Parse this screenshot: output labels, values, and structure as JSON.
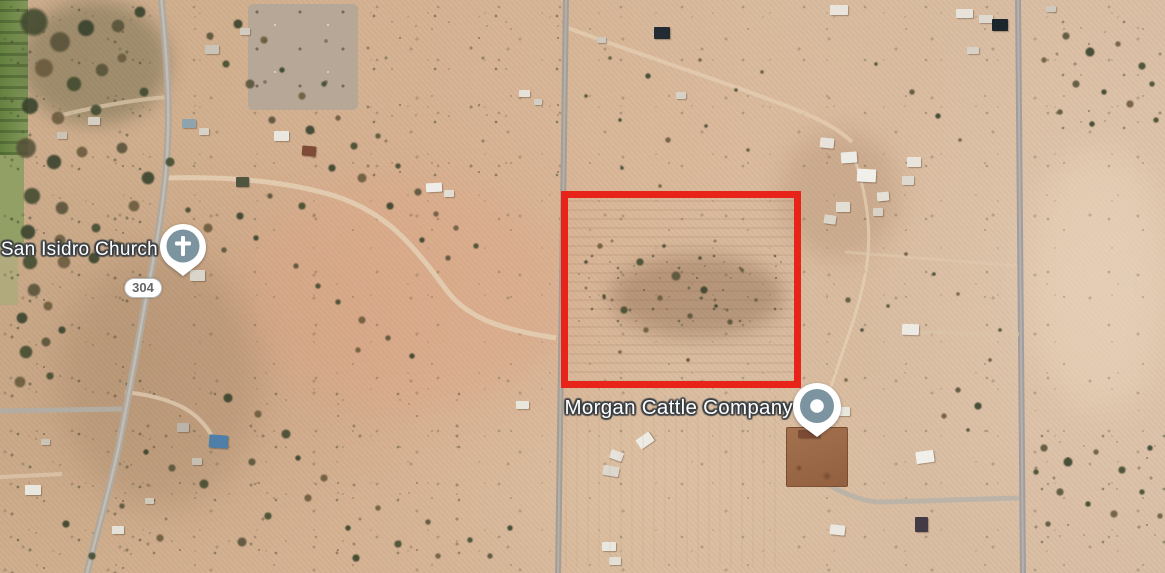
{
  "map": {
    "labels": [
      {
        "id": "church",
        "text": "San Isidro Church",
        "x": 158,
        "y": 250,
        "font_size": 19
      },
      {
        "id": "morgan",
        "text": "Morgan Cattle Company",
        "x": 793,
        "y": 408,
        "font_size": 20.5
      }
    ],
    "route_shield": {
      "text": "304",
      "x": 143,
      "y": 288
    },
    "parcel_outline": {
      "x": 561,
      "y": 191,
      "width": 240,
      "height": 197,
      "thickness": 7,
      "color": "#e8231a"
    },
    "pins": [
      {
        "id": "church",
        "type": "cross-pin",
        "cx": 183,
        "cy": 246
      },
      {
        "id": "morgan",
        "type": "dot-pin",
        "cx": 817,
        "cy": 406
      }
    ],
    "colors": {
      "desert_base": "#d5b292",
      "desert_pink": "#ddb8a0",
      "vegetation": "#40492e",
      "paved_road": "#aba49b",
      "dirt_road": "#e3cdb1",
      "pin_fill": "#7c94a0",
      "parcel_red": "#e8231a",
      "label_text": "#ffffff",
      "label_outline": "#363c40",
      "shield_bg": "#ffffff",
      "shield_text": "#656565",
      "field_green": "#748c4c"
    },
    "tree_colors": [
      "#40492e",
      "#565138",
      "#35402a",
      "#69593c"
    ],
    "buildings": [
      [
        830,
        5,
        18,
        10,
        "#e9e5dd",
        0
      ],
      [
        597,
        37,
        9,
        6,
        "#cfc8bd",
        0
      ],
      [
        654,
        27,
        16,
        12,
        "#232b32",
        0
      ],
      [
        676,
        92,
        10,
        7,
        "#d8d2c6",
        0
      ],
      [
        519,
        90,
        11,
        7,
        "#e6e2da",
        0
      ],
      [
        534,
        99,
        8,
        6,
        "#d5cfc3",
        0
      ],
      [
        956,
        9,
        17,
        9,
        "#e7e3db",
        0
      ],
      [
        979,
        15,
        14,
        8,
        "#dfdad0",
        0
      ],
      [
        992,
        19,
        16,
        12,
        "#1b252c",
        0
      ],
      [
        967,
        47,
        12,
        7,
        "#d8d2c6",
        0
      ],
      [
        1046,
        6,
        10,
        6,
        "#cfc8bd",
        0
      ],
      [
        820,
        138,
        14,
        10,
        "#e7e3db",
        6
      ],
      [
        841,
        152,
        16,
        11,
        "#edebe5",
        -4
      ],
      [
        857,
        169,
        19,
        13,
        "#f1efe9",
        3
      ],
      [
        836,
        202,
        14,
        10,
        "#e3ded4",
        0
      ],
      [
        824,
        215,
        12,
        9,
        "#dad4c9",
        8
      ],
      [
        907,
        157,
        14,
        10,
        "#e9e5dd",
        0
      ],
      [
        902,
        176,
        12,
        9,
        "#ded9cf",
        0
      ],
      [
        877,
        192,
        12,
        9,
        "#e5e1d7",
        -5
      ],
      [
        873,
        208,
        10,
        8,
        "#d7d1c6",
        0
      ],
      [
        182,
        119,
        14,
        9,
        "#8fa3ad",
        0
      ],
      [
        199,
        128,
        10,
        7,
        "#d8d2c6",
        0
      ],
      [
        274,
        131,
        15,
        10,
        "#eae7e0",
        0
      ],
      [
        302,
        146,
        14,
        10,
        "#7e4b38",
        5
      ],
      [
        236,
        177,
        13,
        10,
        "#50553f",
        0
      ],
      [
        88,
        117,
        12,
        8,
        "#d5cfc3",
        0
      ],
      [
        57,
        132,
        10,
        7,
        "#cac3b6",
        0
      ],
      [
        426,
        183,
        16,
        9,
        "#efede7",
        -3
      ],
      [
        444,
        190,
        10,
        7,
        "#e1ddd3",
        0
      ],
      [
        190,
        270,
        15,
        11,
        "#dad5ca",
        0
      ],
      [
        205,
        45,
        14,
        9,
        "#c9c3b8",
        0
      ],
      [
        240,
        28,
        10,
        7,
        "#d2ccc0",
        0
      ],
      [
        209,
        435,
        19,
        13,
        "#4d7fa8",
        4
      ],
      [
        177,
        423,
        12,
        9,
        "#bab3a7",
        0
      ],
      [
        192,
        458,
        10,
        7,
        "#c5beb1",
        0
      ],
      [
        25,
        485,
        16,
        10,
        "#eae7e0",
        0
      ],
      [
        112,
        526,
        12,
        8,
        "#e5e2d9",
        0
      ],
      [
        145,
        498,
        9,
        6,
        "#d0cabd",
        0
      ],
      [
        41,
        439,
        9,
        6,
        "#cac4b7",
        0
      ],
      [
        516,
        401,
        13,
        8,
        "#e9e6de",
        0
      ],
      [
        637,
        435,
        16,
        11,
        "#edebe4",
        -35
      ],
      [
        610,
        451,
        13,
        9,
        "#e7e3db",
        20
      ],
      [
        603,
        466,
        16,
        10,
        "#ddd8cd",
        10
      ],
      [
        602,
        542,
        14,
        9,
        "#eae7e0",
        0
      ],
      [
        609,
        557,
        12,
        8,
        "#e3dfd5",
        0
      ],
      [
        798,
        430,
        22,
        8,
        "#7c4a34",
        0
      ],
      [
        836,
        407,
        14,
        9,
        "#e9e6de",
        0
      ],
      [
        830,
        525,
        15,
        10,
        "#ebe8e1",
        6
      ],
      [
        916,
        451,
        18,
        12,
        "#f1efea",
        -8
      ],
      [
        915,
        517,
        13,
        15,
        "#423b46",
        0
      ],
      [
        902,
        324,
        17,
        11,
        "#edeae3",
        2
      ]
    ],
    "trees": [
      [
        34,
        22,
        15
      ],
      [
        60,
        42,
        11
      ],
      [
        86,
        28,
        9
      ],
      [
        44,
        68,
        10
      ],
      [
        74,
        84,
        8
      ],
      [
        102,
        70,
        7
      ],
      [
        30,
        106,
        9
      ],
      [
        58,
        118,
        7
      ],
      [
        96,
        110,
        6
      ],
      [
        26,
        148,
        11
      ],
      [
        54,
        162,
        8
      ],
      [
        82,
        152,
        6
      ],
      [
        32,
        196,
        9
      ],
      [
        62,
        208,
        7
      ],
      [
        28,
        232,
        8
      ],
      [
        60,
        240,
        6
      ],
      [
        96,
        228,
        5
      ],
      [
        118,
        26,
        7
      ],
      [
        140,
        12,
        6
      ],
      [
        122,
        58,
        5
      ],
      [
        144,
        92,
        5
      ],
      [
        122,
        148,
        6
      ],
      [
        148,
        178,
        7
      ],
      [
        134,
        206,
        6
      ],
      [
        170,
        162,
        5
      ],
      [
        118,
        246,
        5
      ],
      [
        94,
        258,
        6
      ],
      [
        64,
        262,
        7
      ],
      [
        30,
        262,
        8
      ],
      [
        34,
        290,
        7
      ],
      [
        22,
        318,
        6
      ],
      [
        48,
        306,
        5
      ],
      [
        26,
        352,
        7
      ],
      [
        46,
        342,
        5
      ],
      [
        62,
        330,
        4
      ],
      [
        20,
        382,
        6
      ],
      [
        50,
        376,
        4
      ],
      [
        210,
        36,
        4
      ],
      [
        238,
        24,
        5
      ],
      [
        264,
        40,
        4
      ],
      [
        226,
        64,
        4
      ],
      [
        250,
        84,
        5
      ],
      [
        282,
        70,
        3
      ],
      [
        302,
        96,
        4
      ],
      [
        324,
        84,
        3
      ],
      [
        272,
        120,
        4
      ],
      [
        310,
        130,
        5
      ],
      [
        338,
        118,
        3
      ],
      [
        354,
        146,
        4
      ],
      [
        378,
        136,
        3
      ],
      [
        332,
        168,
        4
      ],
      [
        362,
        178,
        5
      ],
      [
        398,
        166,
        3
      ],
      [
        418,
        192,
        4
      ],
      [
        390,
        206,
        4
      ],
      [
        436,
        214,
        3
      ],
      [
        302,
        206,
        4
      ],
      [
        270,
        196,
        3
      ],
      [
        240,
        216,
        4
      ],
      [
        208,
        228,
        5
      ],
      [
        188,
        210,
        3
      ],
      [
        224,
        250,
        3
      ],
      [
        256,
        238,
        3
      ],
      [
        456,
        228,
        3
      ],
      [
        476,
        246,
        3
      ],
      [
        448,
        258,
        3
      ],
      [
        422,
        240,
        3
      ],
      [
        362,
        320,
        4
      ],
      [
        338,
        302,
        3
      ],
      [
        388,
        338,
        3
      ],
      [
        412,
        356,
        3
      ],
      [
        358,
        350,
        3
      ],
      [
        318,
        286,
        3
      ],
      [
        296,
        266,
        3
      ],
      [
        228,
        398,
        5
      ],
      [
        258,
        414,
        4
      ],
      [
        286,
        434,
        5
      ],
      [
        252,
        462,
        4
      ],
      [
        298,
        458,
        3
      ],
      [
        324,
        478,
        4
      ],
      [
        204,
        484,
        5
      ],
      [
        172,
        468,
        4
      ],
      [
        146,
        452,
        3
      ],
      [
        308,
        498,
        4
      ],
      [
        268,
        516,
        4
      ],
      [
        242,
        542,
        5
      ],
      [
        348,
        528,
        3
      ],
      [
        378,
        508,
        3
      ],
      [
        398,
        544,
        4
      ],
      [
        428,
        522,
        3
      ],
      [
        356,
        558,
        4
      ],
      [
        160,
        538,
        4
      ],
      [
        92,
        556,
        4
      ],
      [
        122,
        506,
        3
      ],
      [
        66,
        524,
        4
      ],
      [
        438,
        556,
        3
      ],
      [
        470,
        540,
        3
      ],
      [
        490,
        556,
        3
      ],
      [
        510,
        528,
        3
      ],
      [
        600,
        246,
        3
      ],
      [
        640,
        262,
        4
      ],
      [
        676,
        276,
        5
      ],
      [
        704,
        290,
        4
      ],
      [
        660,
        298,
        3
      ],
      [
        624,
        310,
        4
      ],
      [
        690,
        316,
        3
      ],
      [
        716,
        306,
        2
      ],
      [
        646,
        330,
        3
      ],
      [
        604,
        296,
        2
      ],
      [
        730,
        322,
        3
      ],
      [
        586,
        262,
        2
      ],
      [
        756,
        300,
        2
      ],
      [
        700,
        258,
        2
      ],
      [
        742,
        270,
        2
      ],
      [
        664,
        246,
        2
      ],
      [
        620,
        352,
        2
      ],
      [
        688,
        360,
        2
      ],
      [
        610,
        58,
        2
      ],
      [
        648,
        76,
        3
      ],
      [
        700,
        60,
        2
      ],
      [
        736,
        90,
        2
      ],
      [
        762,
        72,
        2
      ],
      [
        620,
        120,
        2
      ],
      [
        668,
        140,
        3
      ],
      [
        706,
        126,
        2
      ],
      [
        748,
        150,
        2
      ],
      [
        622,
        168,
        2
      ],
      [
        660,
        186,
        2
      ],
      [
        586,
        96,
        2
      ],
      [
        1066,
        36,
        4
      ],
      [
        1090,
        52,
        5
      ],
      [
        1118,
        44,
        3
      ],
      [
        1142,
        66,
        4
      ],
      [
        1076,
        84,
        4
      ],
      [
        1104,
        92,
        3
      ],
      [
        1130,
        104,
        4
      ],
      [
        1152,
        84,
        3
      ],
      [
        1060,
        112,
        3
      ],
      [
        1092,
        124,
        3
      ],
      [
        1044,
        60,
        3
      ],
      [
        1156,
        120,
        3
      ],
      [
        1044,
        448,
        4
      ],
      [
        1068,
        462,
        5
      ],
      [
        1096,
        452,
        3
      ],
      [
        1122,
        470,
        4
      ],
      [
        1060,
        492,
        4
      ],
      [
        1088,
        504,
        3
      ],
      [
        1114,
        514,
        4
      ],
      [
        1142,
        492,
        3
      ],
      [
        1048,
        524,
        3
      ],
      [
        1150,
        448,
        3
      ],
      [
        1160,
        516,
        3
      ],
      [
        1036,
        472,
        3
      ],
      [
        958,
        390,
        3
      ],
      [
        978,
        406,
        4
      ],
      [
        944,
        416,
        3
      ],
      [
        968,
        430,
        2
      ],
      [
        912,
        92,
        3
      ],
      [
        938,
        116,
        3
      ],
      [
        960,
        140,
        2
      ],
      [
        876,
        64,
        2
      ],
      [
        906,
        254,
        2
      ],
      [
        934,
        274,
        2
      ],
      [
        958,
        294,
        2
      ],
      [
        888,
        306,
        2
      ],
      [
        848,
        300,
        3
      ],
      [
        862,
        330,
        2
      ],
      [
        846,
        380,
        2
      ],
      [
        1000,
        330,
        2
      ],
      [
        990,
        360,
        2
      ]
    ]
  }
}
